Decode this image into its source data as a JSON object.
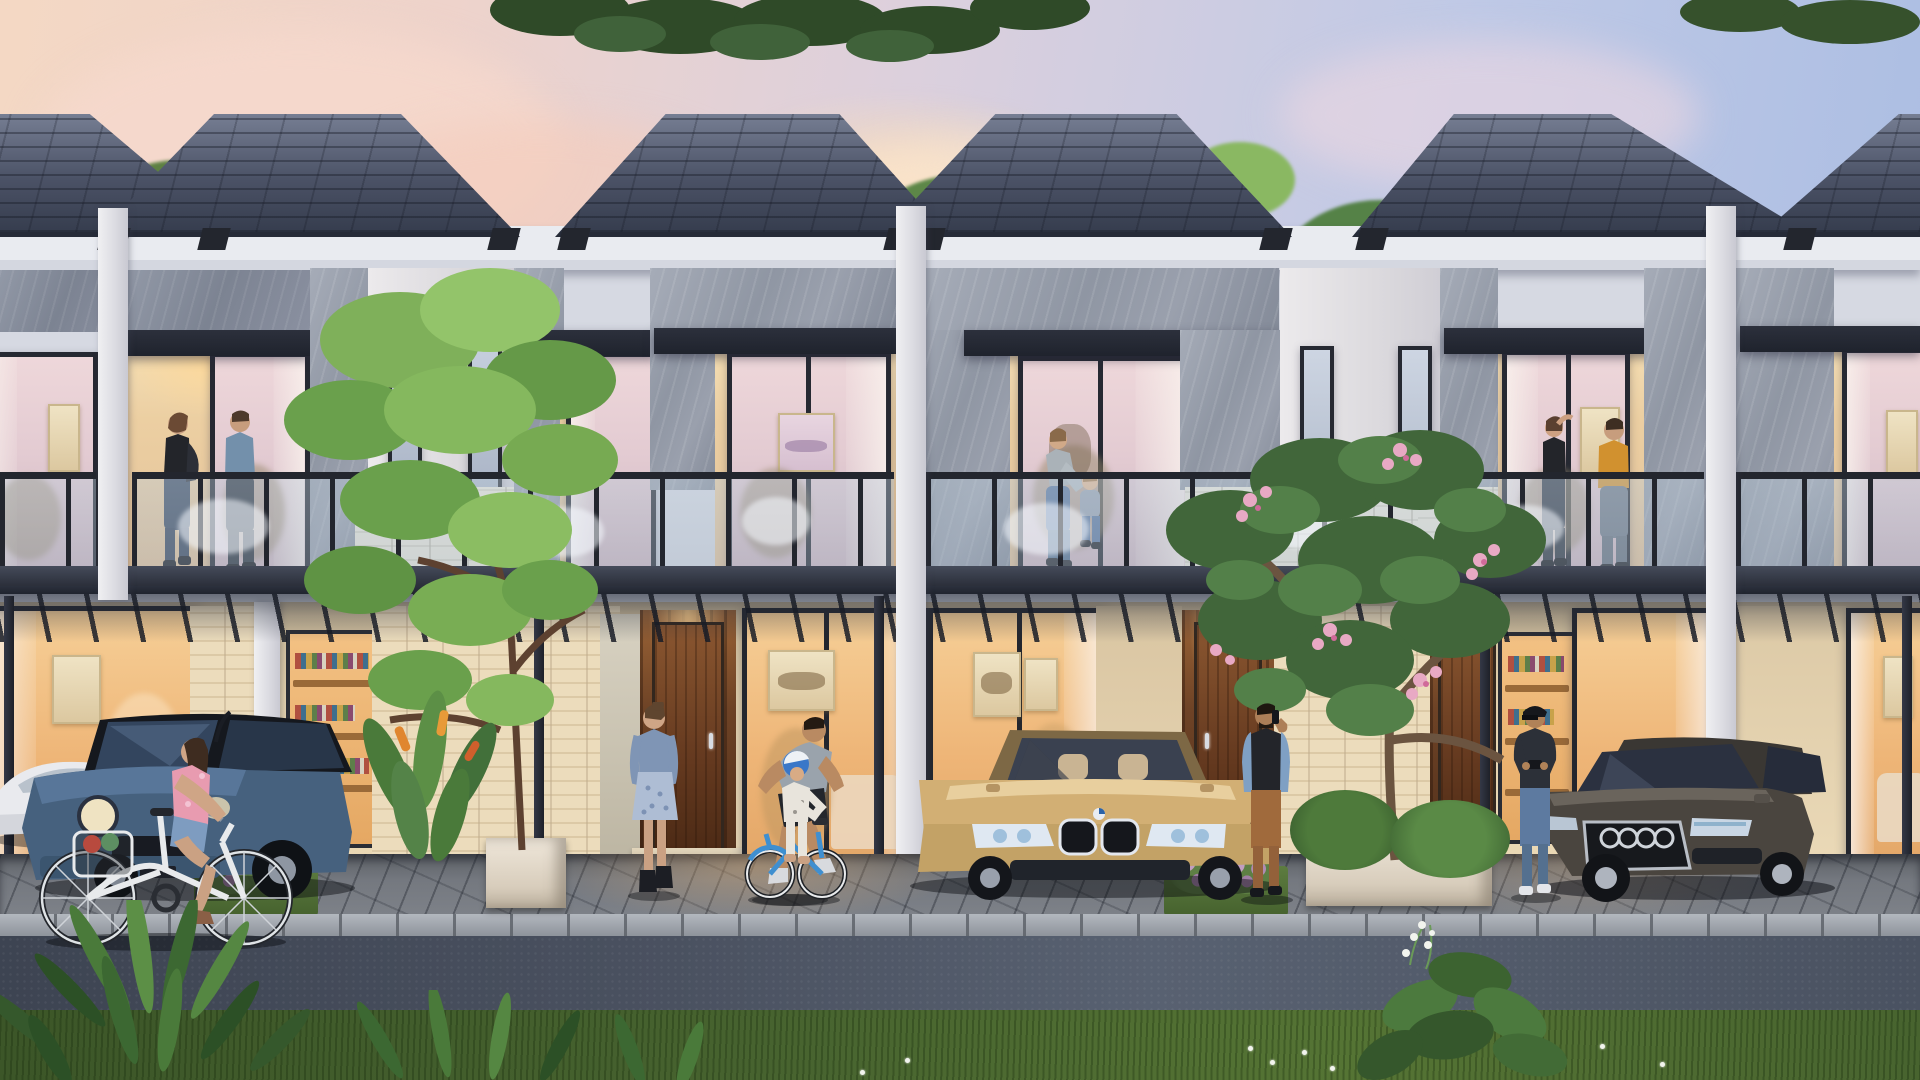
{
  "scene": {
    "title": "Row of modern two-storey townhouses at dusk with warm interior lighting",
    "setting": "residential street scene, evening sky, tropical landscaping",
    "units_visible": 6,
    "sky_colors": {
      "left_pink": "#f4d8c4",
      "right_blue": "#a9bce2",
      "cloud": "#f7e6da"
    }
  },
  "architecture": {
    "roof_color": "#4b5266",
    "fascia_color": "#e9ebf0",
    "stone_color": "#9aa0ad",
    "brick_color": "#ebe7da",
    "pergola_color": "#262a33",
    "warm_light": "#f6cf97",
    "labels": {
      "roof": "dark shingled hip roof",
      "fascia": "white fascia band",
      "balcony": "glass-railed balcony with couple",
      "pergola": "black steel and glass carport canopy",
      "door": "timber entry door with downlight",
      "upper_window": "full-height bedroom window, pink dusk glow",
      "ground_window": "warm-lit living room window",
      "shelf_window": "window showing bookshelves",
      "party_wall": "white party wall with two slim windows and cream brick base"
    }
  },
  "vehicles": [
    {
      "label": "white coupe partially visible at far left",
      "color": "#e9eaee"
    },
    {
      "label": "steel-blue hatchback with black roof in left carport",
      "color": "#4a6684"
    },
    {
      "label": "champagne-gold sedan with twin-kidney grille in centre carport",
      "color": "#c9a76d"
    },
    {
      "label": "graphite sedan with four-ring grille in right carport",
      "color": "#4a453f"
    }
  ],
  "people": [
    {
      "label": "couple chatting on left balcony"
    },
    {
      "label": "mother steadying toddler on centre balcony"
    },
    {
      "label": "couple on right balcony, man in mustard sweater"
    },
    {
      "label": "woman riding white cruiser bicycle past the houses"
    },
    {
      "label": "mother in denim jacket watching in driveway"
    },
    {
      "label": "father helping child learn to ride"
    },
    {
      "label": "child on small blue bicycle wearing blue helmet"
    },
    {
      "label": "man talking on phone at entry door"
    },
    {
      "label": "man in cap checking phone beside graphite sedan"
    }
  ],
  "landscape": {
    "labels": {
      "background_trees": "lush background trees behind roofline",
      "ornamental_tree": "young ornamental tree in white planter",
      "frangipani": "frangipani tree with pink blossoms in white planter",
      "heliconia": "heliconia shrub with orange blooms",
      "lavender": "flowering shrub on grass strip between driveways",
      "ferns": "foreground ferns at street edge",
      "flower_plant": "leafy plant with white blossoms at lower right",
      "lawn": "grass verge in the foreground"
    },
    "foliage_colors": [
      "#3a5930",
      "#5f8544",
      "#7da457",
      "#9cc06a"
    ]
  },
  "street": {
    "asphalt_color": "#4a5160",
    "curb_color": "#b3b8bf",
    "paver_color": "#74787f",
    "grass_color": "#47632f"
  }
}
